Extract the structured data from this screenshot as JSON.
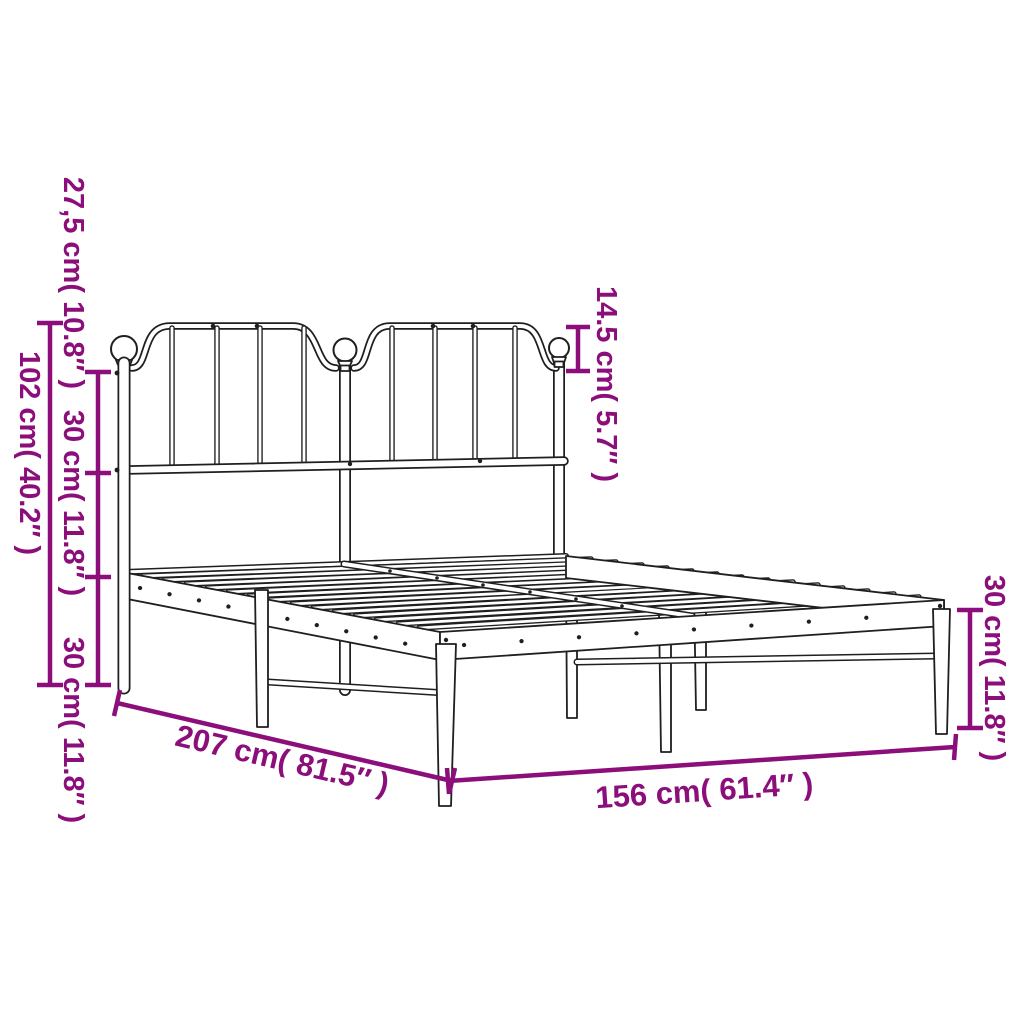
{
  "diagram": {
    "title": "Metal bed frame with headboard — dimension diagram",
    "background_color": "#ffffff",
    "line_color": "#1f1f1f",
    "accent_color": "#8B0E7A",
    "measurements": [
      {
        "id": "headboard-top-drop",
        "text": "27,5 cm( 10.8″ )",
        "placement": "left-inner-top"
      },
      {
        "id": "headboard-upper-section",
        "text": "30 cm( 11.8″ )",
        "placement": "left-inner-middle"
      },
      {
        "id": "headboard-lower-section",
        "text": "30 cm( 11.8″ )",
        "placement": "left-inner-bottom"
      },
      {
        "id": "headboard-total-height",
        "text": "102 cm( 40.2″ )",
        "placement": "left-outer"
      },
      {
        "id": "finial-to-arch-height",
        "text": "14.5 cm( 5.7″ )",
        "placement": "center-top"
      },
      {
        "id": "frame-height",
        "text": "30 cm( 11.8″ )",
        "placement": "right"
      },
      {
        "id": "bed-length",
        "text": "207 cm( 81.5″ )",
        "placement": "bottom-left-diagonal"
      },
      {
        "id": "bed-width",
        "text": "156 cm( 61.4″ )",
        "placement": "bottom"
      }
    ]
  }
}
